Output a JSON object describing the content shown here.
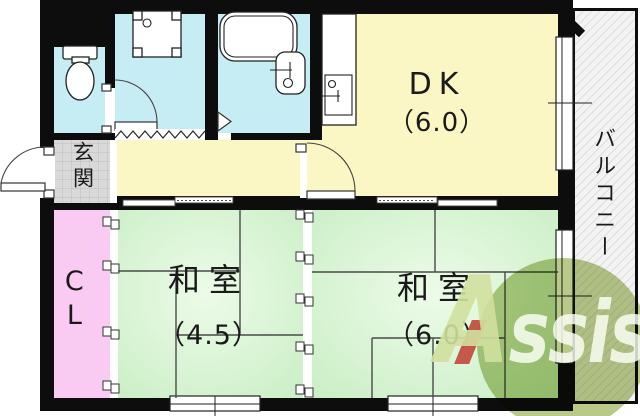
{
  "plan": {
    "type": "apartment-floor-plan",
    "rooms": {
      "dk": {
        "label": "DK",
        "size": "（6.0）"
      },
      "washitsu_45": {
        "label": "和室",
        "size": "（4.5）"
      },
      "washitsu_60": {
        "label": "和室",
        "size": "（6.0）"
      },
      "genkan": {
        "label": "玄関"
      },
      "closet": {
        "label": "CL"
      },
      "balcony": {
        "label": "バルコニー"
      }
    },
    "fixtures": [
      "toilet-icon",
      "washing-machine-icon",
      "bathtub-icon",
      "vanity-sink-icon",
      "kitchen-sink-icon"
    ]
  },
  "watermark": {
    "text": "Assist",
    "letter_a": "A",
    "letters_rest": "ssist"
  },
  "colors": {
    "wall": "#0d0d0d",
    "dk_floor": "#fbf7c4",
    "wet_blue": "#c6edf4",
    "closet_pink": "#f9cbf2",
    "genkan_gray": "#d9d9d9",
    "tatami_green": "#c9eec5",
    "tatami_light": "#edfbe8",
    "tatami_line": "#4a4a4a",
    "balcony_bg": "#f3f3f3",
    "watermark_olive": "#b8c98a",
    "watermark_red": "#c1473a"
  }
}
